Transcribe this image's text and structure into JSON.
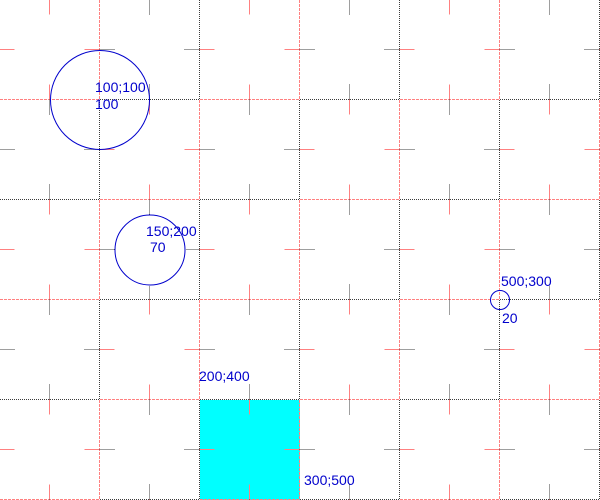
{
  "canvas": {
    "width": 600,
    "height": 500,
    "background": "#ffffff"
  },
  "grid": {
    "cell_size": 100,
    "tick_half_length": 15,
    "pink_color": "#ff8080",
    "black_color": "#3c3c3c",
    "pink_dash": "3,1",
    "black_dash": "1,1"
  },
  "style": {
    "shape_stroke_color": "#0000cc",
    "label_text_color": "#0000cc",
    "square_fill_color": "#00ffff"
  },
  "shapes": [
    {
      "id": "circle-1",
      "type": "circle",
      "cx": 100,
      "cy": 100,
      "r": 49.5,
      "labels": [
        {
          "name": "circle-1-center-label",
          "text": "100;100",
          "x": 95,
          "y": 80
        },
        {
          "name": "circle-1-size-label",
          "text": "100",
          "x": 95,
          "y": 97
        }
      ]
    },
    {
      "id": "circle-2",
      "type": "circle",
      "cx": 150,
      "cy": 250,
      "r": 35,
      "labels": [
        {
          "name": "circle-2-center-label",
          "text": "150;200",
          "x": 146,
          "y": 224
        },
        {
          "name": "circle-2-size-label",
          "text": "70",
          "x": 150,
          "y": 240
        }
      ]
    },
    {
      "id": "circle-3",
      "type": "circle",
      "cx": 500,
      "cy": 300,
      "r": 9.5,
      "labels": [
        {
          "name": "circle-3-center-label",
          "text": "500;300",
          "x": 501,
          "y": 274
        },
        {
          "name": "circle-3-size-label",
          "text": "20",
          "x": 502,
          "y": 311
        }
      ]
    },
    {
      "id": "square-1",
      "type": "rect",
      "x": 200,
      "y": 400,
      "width": 100,
      "height": 100,
      "labels": [
        {
          "name": "square-1-topleft-label",
          "text": "200;400",
          "x": 199,
          "y": 369
        },
        {
          "name": "square-1-bottomright-label",
          "text": "300;500",
          "x": 304,
          "y": 473
        }
      ]
    }
  ]
}
